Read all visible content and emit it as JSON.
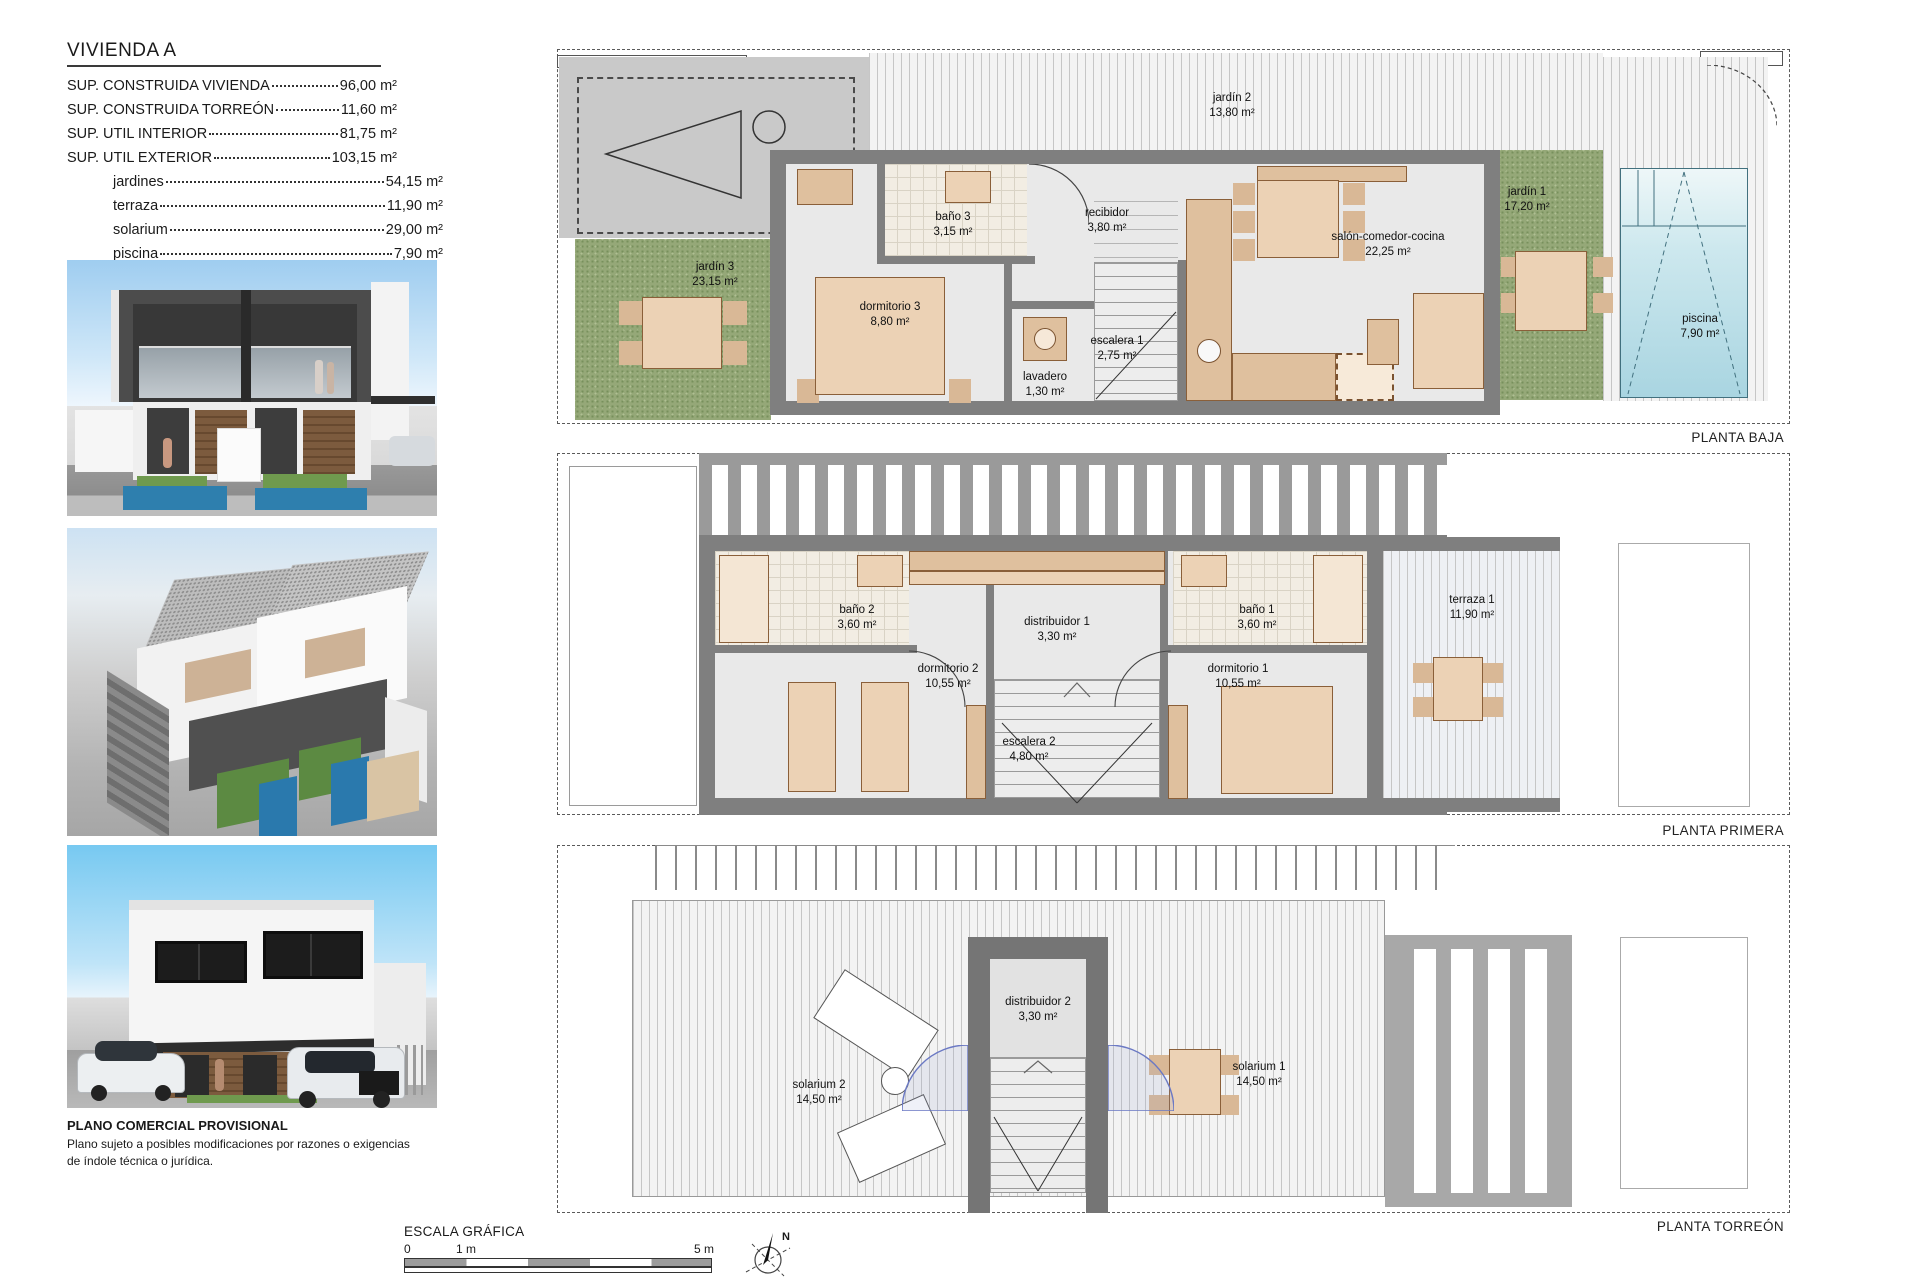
{
  "title_block": {
    "title": "VIVIENDA A",
    "rows": [
      {
        "label": "SUP. CONSTRUIDA VIVIENDA",
        "value": "96,00 m²"
      },
      {
        "label": "SUP. CONSTRUIDA TORREÓN",
        "value": "11,60 m²"
      },
      {
        "label": "SUP. UTIL INTERIOR",
        "value": "81,75 m²"
      },
      {
        "label": "SUP. UTIL EXTERIOR",
        "value": "103,15 m²"
      }
    ],
    "subrows": [
      {
        "label": "jardines",
        "value": "54,15 m²"
      },
      {
        "label": "terraza",
        "value": "11,90 m²"
      },
      {
        "label": "solarium",
        "value": "29,00 m²"
      },
      {
        "label": "piscina",
        "value": "7,90 m²"
      }
    ]
  },
  "disclaimer": {
    "title": "PLANO COMERCIAL PROVISIONAL",
    "body": "Plano sujeto a posibles modificaciones por razones o exigencias de índole técnica o jurídica."
  },
  "scale_bar": {
    "title": "ESCALA GRÁFICA",
    "tick0": "0",
    "tick1": "1 m",
    "tick5": "5 m"
  },
  "compass": {
    "north": "N"
  },
  "plans": {
    "baja": {
      "caption": "PLANTA BAJA",
      "rooms": [
        {
          "name": "jardín 2",
          "area": "13,80 m²"
        },
        {
          "name": "jardín 3",
          "area": "23,15 m²"
        },
        {
          "name": "baño 3",
          "area": "3,15 m²"
        },
        {
          "name": "recibidor",
          "area": "3,80 m²"
        },
        {
          "name": "dormitorio 3",
          "area": "8,80 m²"
        },
        {
          "name": "lavadero",
          "area": "1,30 m²"
        },
        {
          "name": "escalera 1",
          "area": "2,75 m²"
        },
        {
          "name": "salón-comedor-cocina",
          "area": "22,25 m²"
        },
        {
          "name": "jardín 1",
          "area": "17,20 m²"
        },
        {
          "name": "piscina",
          "area": "7,90 m²"
        }
      ]
    },
    "primera": {
      "caption": "PLANTA PRIMERA",
      "rooms": [
        {
          "name": "baño 2",
          "area": "3,60 m²"
        },
        {
          "name": "distribuidor 1",
          "area": "3,30 m²"
        },
        {
          "name": "baño 1",
          "area": "3,60 m²"
        },
        {
          "name": "dormitorio 2",
          "area": "10,55 m²"
        },
        {
          "name": "dormitorio 1",
          "area": "10,55 m²"
        },
        {
          "name": "escalera 2",
          "area": "4,80 m²"
        },
        {
          "name": "terraza 1",
          "area": "11,90 m²"
        }
      ]
    },
    "torreon": {
      "caption": "PLANTA TORREÓN",
      "rooms": [
        {
          "name": "solarium 2",
          "area": "14,50 m²"
        },
        {
          "name": "distribuidor 2",
          "area": "3,30 m²"
        },
        {
          "name": "solarium 1",
          "area": "14,50 m²"
        }
      ]
    }
  },
  "colors": {
    "wall_grey": "#7f7f7f",
    "garden_green": "#95a878",
    "pool_blue": "#a9d5e1",
    "furniture_tan": "#ecd2b5"
  }
}
